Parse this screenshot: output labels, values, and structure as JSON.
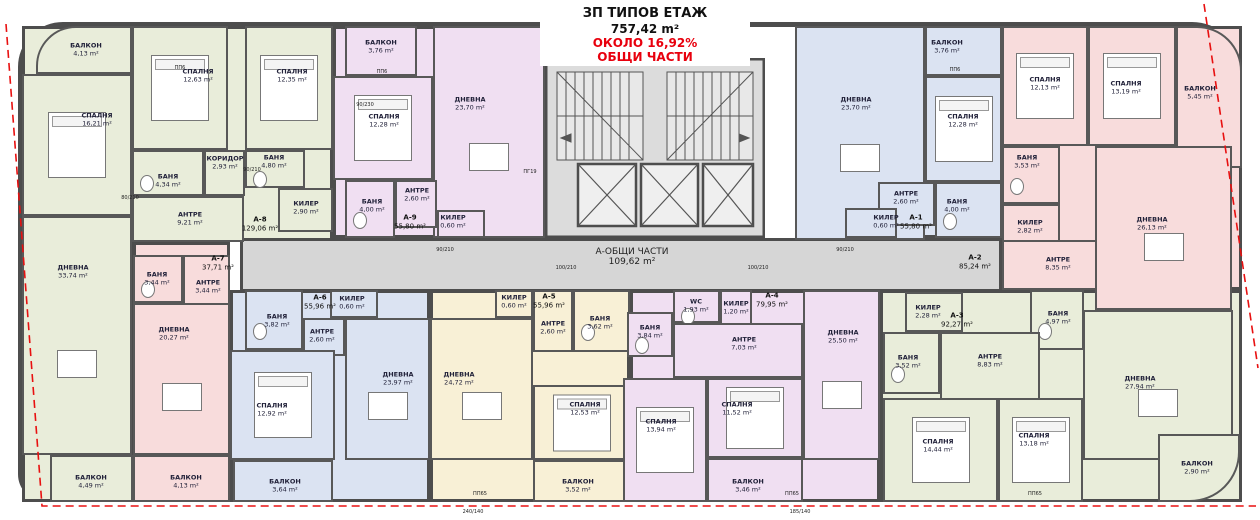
{
  "title": {
    "line1": "ЗП ТИПОВ ЕТАЖ",
    "line2": "757,42 m²",
    "line3": "ОКОЛО 16,92%",
    "line4": "ОБЩИ ЧАСТИ"
  },
  "common": {
    "label": "А-ОБЩИ ЧАСТИ",
    "area": "109,62 m²"
  },
  "colors": {
    "wall": "#4d4d4d",
    "green": "#e9edda",
    "pink": "#f8dcdc",
    "purple": "#f0dff2",
    "blue": "#dbe3f2",
    "yellow": "#f8f0d6",
    "gray": "#d6d6d6",
    "red": "#e8000d"
  },
  "apartments": [
    {
      "id": "А-1",
      "area": "55,80 m²",
      "x": 916,
      "y": 222
    },
    {
      "id": "А-2",
      "area": "85,24 m²",
      "x": 975,
      "y": 262
    },
    {
      "id": "А-3",
      "area": "92,27 m²",
      "x": 957,
      "y": 320
    },
    {
      "id": "А-4",
      "area": "79,95 m²",
      "x": 772,
      "y": 300
    },
    {
      "id": "А-5",
      "area": "55,96 m²",
      "x": 549,
      "y": 301
    },
    {
      "id": "А-6",
      "area": "55,96 m²",
      "x": 320,
      "y": 302
    },
    {
      "id": "А-7",
      "area": "37,71 m²",
      "x": 218,
      "y": 263
    },
    {
      "id": "А-8",
      "area": "129,06 m²",
      "x": 260,
      "y": 224
    },
    {
      "id": "А-9",
      "area": "55,80 m²",
      "x": 410,
      "y": 222
    }
  ],
  "apartment_zones": [
    {
      "id": "А-8",
      "r": [
        22,
        26,
        311,
        216
      ],
      "c": "green"
    },
    {
      "id": "А-8",
      "r": [
        22,
        216,
        111,
        286
      ],
      "c": "green"
    },
    {
      "id": "А-9",
      "r": [
        333,
        26,
        212,
        212
      ],
      "c": "purple"
    },
    {
      "id": "А-1",
      "r": [
        795,
        26,
        207,
        212
      ],
      "c": "blue"
    },
    {
      "id": "А-2",
      "r": [
        1000,
        26,
        242,
        264
      ],
      "c": "pink"
    },
    {
      "id": "А-3",
      "r": [
        880,
        290,
        362,
        212
      ],
      "c": "green"
    },
    {
      "id": "А-4",
      "r": [
        630,
        290,
        250,
        212
      ],
      "c": "purple"
    },
    {
      "id": "А-5",
      "r": [
        430,
        290,
        200,
        212
      ],
      "c": "yellow"
    },
    {
      "id": "А-6",
      "r": [
        230,
        290,
        200,
        212
      ],
      "c": "blue"
    },
    {
      "id": "А-7",
      "r": [
        133,
        242,
        97,
        260
      ],
      "c": "pink"
    },
    {
      "id": "corridor",
      "r": [
        240,
        238,
        762,
        54
      ],
      "c": "gray"
    },
    {
      "id": "core",
      "r": [
        545,
        58,
        220,
        180
      ],
      "c": "gray"
    }
  ],
  "rooms": [
    {
      "a": "А-8",
      "n": "БАЛКОН",
      "ar": "4,13 m²",
      "r": [
        36,
        26,
        96,
        48
      ],
      "c": "green",
      "rad": "40px 0 0 0",
      "lp": [
        86,
        50
      ]
    },
    {
      "a": "А-8",
      "n": "СПАЛНЯ",
      "ar": "12,63 m²",
      "r": [
        132,
        26,
        96,
        124
      ],
      "c": "green",
      "lp": [
        198,
        76
      ]
    },
    {
      "a": "А-8",
      "n": "СПАЛНЯ",
      "ar": "16,21 m²",
      "r": [
        22,
        74,
        110,
        142
      ],
      "c": "green",
      "lp": [
        97,
        120
      ]
    },
    {
      "a": "А-8",
      "n": "СПАЛНЯ",
      "ar": "12,35 m²",
      "r": [
        245,
        26,
        88,
        124
      ],
      "c": "green",
      "lp": [
        292,
        76
      ]
    },
    {
      "a": "А-8",
      "n": "КОРИДОР",
      "ar": "2,93 m²",
      "r": [
        204,
        150,
        41,
        46
      ],
      "c": "green",
      "lp": [
        225,
        163
      ]
    },
    {
      "a": "А-8",
      "n": "БАНЯ",
      "ar": "4,34 m²",
      "r": [
        132,
        150,
        72,
        46
      ],
      "c": "green",
      "lp": [
        168,
        181
      ]
    },
    {
      "a": "А-8",
      "n": "БАНЯ",
      "ar": "4,80 m²",
      "r": [
        245,
        150,
        60,
        38
      ],
      "c": "green",
      "lp": [
        274,
        162
      ]
    },
    {
      "a": "А-8",
      "n": "КИЛЕР",
      "ar": "2,90 m²",
      "r": [
        278,
        188,
        55,
        44
      ],
      "c": "green",
      "lp": [
        306,
        208
      ]
    },
    {
      "a": "А-8",
      "n": "АНТРЕ",
      "ar": "9,21 m²",
      "r": [
        132,
        196,
        112,
        46
      ],
      "c": "green",
      "lp": [
        190,
        219
      ]
    },
    {
      "a": "А-8",
      "n": "ДНЕВНА",
      "ar": "33,74 m²",
      "r": [
        22,
        216,
        110,
        239
      ],
      "c": "green",
      "lp": [
        73,
        272
      ]
    },
    {
      "a": "А-8",
      "n": "БАЛКОН",
      "ar": "4,49 m²",
      "r": [
        50,
        455,
        83,
        47
      ],
      "c": "green",
      "lp": [
        91,
        482
      ]
    },
    {
      "a": "А-7",
      "n": "БАНЯ",
      "ar": "3,44 m²",
      "r": [
        133,
        255,
        50,
        48
      ],
      "c": "pink",
      "lp": [
        157,
        279
      ]
    },
    {
      "a": "А-7",
      "n": "АНТРЕ",
      "ar": "3,44 m²",
      "r": [
        183,
        255,
        47,
        55
      ],
      "c": "pink",
      "lp": [
        208,
        287
      ]
    },
    {
      "a": "А-7",
      "n": "ДНЕВНА",
      "ar": "20,27 m²",
      "r": [
        133,
        303,
        97,
        152
      ],
      "c": "pink",
      "lp": [
        174,
        334
      ]
    },
    {
      "a": "А-7",
      "n": "БАЛКОН",
      "ar": "4,13 m²",
      "r": [
        133,
        455,
        97,
        47
      ],
      "c": "pink",
      "lp": [
        186,
        482
      ]
    },
    {
      "a": "А-6",
      "n": "БАНЯ",
      "ar": "3,82 m²",
      "r": [
        245,
        290,
        58,
        60
      ],
      "c": "blue",
      "lp": [
        277,
        321
      ]
    },
    {
      "a": "А-6",
      "n": "КИЛЕР",
      "ar": "0,60 m²",
      "r": [
        330,
        290,
        48,
        28
      ],
      "c": "blue",
      "lp": [
        352,
        303
      ]
    },
    {
      "a": "А-6",
      "n": "АНТРЕ",
      "ar": "2,60 m²",
      "r": [
        303,
        318,
        42,
        38
      ],
      "c": "blue",
      "lp": [
        322,
        336
      ]
    },
    {
      "a": "А-6",
      "n": "ДНЕВНА",
      "ar": "23,97 m²",
      "r": [
        345,
        318,
        85,
        142
      ],
      "c": "blue",
      "lp": [
        398,
        379
      ]
    },
    {
      "a": "А-6",
      "n": "СПАЛНЯ",
      "ar": "12,92 m²",
      "r": [
        230,
        350,
        105,
        110
      ],
      "c": "blue",
      "lp": [
        272,
        410
      ]
    },
    {
      "a": "А-6",
      "n": "БАЛКОН",
      "ar": "3,64 m²",
      "r": [
        233,
        460,
        100,
        42
      ],
      "c": "blue",
      "lp": [
        285,
        486
      ]
    },
    {
      "a": "А-5",
      "n": "КИЛЕР",
      "ar": "0,60 m²",
      "r": [
        495,
        290,
        38,
        28
      ],
      "c": "yellow",
      "lp": [
        514,
        302
      ]
    },
    {
      "a": "А-5",
      "n": "АНТРЕ",
      "ar": "2,60 m²",
      "r": [
        533,
        290,
        40,
        62
      ],
      "c": "yellow",
      "lp": [
        553,
        328
      ]
    },
    {
      "a": "А-5",
      "n": "БАНЯ",
      "ar": "3,62 m²",
      "r": [
        573,
        290,
        57,
        62
      ],
      "c": "yellow",
      "lp": [
        600,
        323
      ]
    },
    {
      "a": "А-5",
      "n": "ДНЕВНА",
      "ar": "24,72 m²",
      "r": [
        430,
        318,
        103,
        142
      ],
      "c": "yellow",
      "lp": [
        459,
        379
      ]
    },
    {
      "a": "А-5",
      "n": "СПАЛНЯ",
      "ar": "12,53 m²",
      "r": [
        533,
        385,
        97,
        75
      ],
      "c": "yellow",
      "lp": [
        585,
        409
      ]
    },
    {
      "a": "А-5",
      "n": "БАЛКОН",
      "ar": "3,52 m²",
      "r": [
        533,
        460,
        97,
        42
      ],
      "c": "yellow",
      "lp": [
        578,
        486
      ]
    },
    {
      "a": "А-4",
      "n": "БАНЯ",
      "ar": "3,84 m²",
      "r": [
        627,
        312,
        46,
        45
      ],
      "c": "purple",
      "lp": [
        650,
        332
      ]
    },
    {
      "a": "А-4",
      "n": "WC",
      "ar": "1,93 m²",
      "r": [
        673,
        290,
        47,
        33
      ],
      "c": "purple",
      "lp": [
        696,
        306
      ]
    },
    {
      "a": "А-4",
      "n": "КИЛЕР",
      "ar": "1,20 m²",
      "r": [
        720,
        290,
        32,
        37
      ],
      "c": "purple",
      "lp": [
        736,
        308
      ]
    },
    {
      "a": "А-4",
      "n": "АНТРЕ",
      "ar": "7,03 m²",
      "r": [
        673,
        323,
        130,
        55
      ],
      "c": "purple",
      "lp": [
        744,
        344
      ]
    },
    {
      "a": "А-4",
      "n": "ДНЕВНА",
      "ar": "25,50 m²",
      "r": [
        803,
        290,
        77,
        170
      ],
      "c": "purple",
      "lp": [
        843,
        337
      ]
    },
    {
      "a": "А-4",
      "n": "СПАЛНЯ",
      "ar": "13,94 m²",
      "r": [
        623,
        378,
        84,
        124
      ],
      "c": "purple",
      "lp": [
        661,
        426
      ]
    },
    {
      "a": "А-4",
      "n": "СПАЛНЯ",
      "ar": "11,52 m²",
      "r": [
        707,
        378,
        96,
        80
      ],
      "c": "purple",
      "lp": [
        737,
        409
      ]
    },
    {
      "a": "А-4",
      "n": "БАЛКОН",
      "ar": "3,46 m²",
      "r": [
        707,
        458,
        96,
        44
      ],
      "c": "purple",
      "lp": [
        748,
        486
      ]
    },
    {
      "a": "А-3",
      "n": "КИЛЕР",
      "ar": "2,28 m²",
      "r": [
        905,
        292,
        58,
        40
      ],
      "c": "green",
      "lp": [
        928,
        312
      ]
    },
    {
      "a": "А-3",
      "n": "БАНЯ",
      "ar": "4,97 m²",
      "r": [
        1030,
        290,
        54,
        60
      ],
      "c": "green",
      "lp": [
        1058,
        318
      ]
    },
    {
      "a": "А-3",
      "n": "БАНЯ",
      "ar": "3,52 m²",
      "r": [
        883,
        332,
        57,
        62
      ],
      "c": "green",
      "lp": [
        908,
        362
      ]
    },
    {
      "a": "А-3",
      "n": "АНТРЕ",
      "ar": "8,83 m²",
      "r": [
        940,
        332,
        100,
        70
      ],
      "c": "green",
      "lp": [
        990,
        361
      ]
    },
    {
      "a": "А-3",
      "n": "ДНЕВНА",
      "ar": "27,94 m²",
      "r": [
        1083,
        310,
        150,
        150
      ],
      "c": "green",
      "lp": [
        1140,
        383
      ]
    },
    {
      "a": "А-3",
      "n": "СПАЛНЯ",
      "ar": "14,44 m²",
      "r": [
        883,
        398,
        115,
        104
      ],
      "c": "green",
      "lp": [
        938,
        446
      ]
    },
    {
      "a": "А-3",
      "n": "СПАЛНЯ",
      "ar": "13,18 m²",
      "r": [
        998,
        398,
        85,
        104
      ],
      "c": "green",
      "lp": [
        1034,
        440
      ]
    },
    {
      "a": "А-3",
      "n": "БАЛКОН",
      "ar": "2,90 m²",
      "r": [
        1158,
        434,
        82,
        68
      ],
      "c": "green",
      "rad": "0 0 50px 0",
      "lp": [
        1197,
        468
      ]
    },
    {
      "a": "А-2",
      "n": "СПАЛНЯ",
      "ar": "12,13 m²",
      "r": [
        1002,
        26,
        86,
        120
      ],
      "c": "pink",
      "lp": [
        1045,
        84
      ]
    },
    {
      "a": "А-2",
      "n": "СПАЛНЯ",
      "ar": "13,19 m²",
      "r": [
        1088,
        26,
        88,
        120
      ],
      "c": "pink",
      "lp": [
        1126,
        88
      ]
    },
    {
      "a": "А-2",
      "n": "БАЛКОН",
      "ar": "5,45 m²",
      "r": [
        1176,
        26,
        66,
        142
      ],
      "c": "pink",
      "rad": "0 45px 0 0",
      "lp": [
        1200,
        93
      ]
    },
    {
      "a": "А-2",
      "n": "БАНЯ",
      "ar": "3,53 m²",
      "r": [
        1002,
        146,
        58,
        58
      ],
      "c": "pink",
      "lp": [
        1027,
        162
      ]
    },
    {
      "a": "А-2",
      "n": "КИЛЕР",
      "ar": "2,82 m²",
      "r": [
        1002,
        204,
        58,
        52
      ],
      "c": "pink",
      "lp": [
        1030,
        227
      ]
    },
    {
      "a": "А-2",
      "n": "АНТРЕ",
      "ar": "8,35 m²",
      "r": [
        1002,
        240,
        98,
        50
      ],
      "c": "pink",
      "lp": [
        1058,
        264
      ]
    },
    {
      "a": "А-2",
      "n": "ДНЕВНА",
      "ar": "26,13 m²",
      "r": [
        1095,
        146,
        137,
        164
      ],
      "c": "pink",
      "lp": [
        1152,
        224
      ]
    },
    {
      "a": "А-9",
      "n": "БАЛКОН",
      "ar": "3,76 m²",
      "r": [
        345,
        26,
        72,
        50
      ],
      "c": "purple",
      "lp": [
        381,
        47
      ]
    },
    {
      "a": "А-9",
      "n": "СПАЛНЯ",
      "ar": "12,28 m²",
      "r": [
        333,
        76,
        100,
        104
      ],
      "c": "purple",
      "lp": [
        384,
        121
      ]
    },
    {
      "a": "А-9",
      "n": "ДНЕВНА",
      "ar": "23,70 m²",
      "r": [
        433,
        26,
        112,
        212
      ],
      "c": "purple",
      "lp": [
        470,
        104
      ]
    },
    {
      "a": "А-9",
      "n": "БАНЯ",
      "ar": "4,00 m²",
      "r": [
        345,
        180,
        50,
        58
      ],
      "c": "purple",
      "lp": [
        372,
        206
      ]
    },
    {
      "a": "А-9",
      "n": "АНТРЕ",
      "ar": "2,60 m²",
      "r": [
        395,
        180,
        42,
        48
      ],
      "c": "purple",
      "lp": [
        417,
        195
      ]
    },
    {
      "a": "А-9",
      "n": "КИЛЕР",
      "ar": "0,60 m²",
      "r": [
        437,
        210,
        48,
        28
      ],
      "c": "purple",
      "lp": [
        453,
        222
      ]
    },
    {
      "a": "А-1",
      "n": "ДНЕВНА",
      "ar": "23,70 m²",
      "r": [
        795,
        26,
        130,
        214
      ],
      "c": "blue",
      "lp": [
        856,
        104
      ]
    },
    {
      "a": "А-1",
      "n": "БАЛКОН",
      "ar": "3,76 m²",
      "r": [
        925,
        26,
        77,
        50
      ],
      "c": "blue",
      "lp": [
        947,
        47
      ]
    },
    {
      "a": "А-1",
      "n": "СПАЛНЯ",
      "ar": "12,28 m²",
      "r": [
        925,
        76,
        77,
        106
      ],
      "c": "blue",
      "lp": [
        963,
        121
      ]
    },
    {
      "a": "А-1",
      "n": "АНТРЕ",
      "ar": "2,60 m²",
      "r": [
        878,
        182,
        57,
        44
      ],
      "c": "blue",
      "lp": [
        906,
        198
      ]
    },
    {
      "a": "А-1",
      "n": "БАНЯ",
      "ar": "4,00 m²",
      "r": [
        935,
        182,
        67,
        56
      ],
      "c": "blue",
      "lp": [
        957,
        206
      ]
    },
    {
      "a": "А-1",
      "n": "КИЛЕР",
      "ar": "0,60 m²",
      "r": [
        845,
        208,
        52,
        30
      ],
      "c": "blue",
      "lp": [
        886,
        222
      ]
    }
  ],
  "dimension_marks": [
    {
      "t": "90/210",
      "x": 252,
      "y": 170
    },
    {
      "t": "80/210",
      "x": 130,
      "y": 198
    },
    {
      "t": "100/210",
      "x": 566,
      "y": 268
    },
    {
      "t": "100/210",
      "x": 758,
      "y": 268
    },
    {
      "t": "90/210",
      "x": 445,
      "y": 250
    },
    {
      "t": "90/210",
      "x": 845,
      "y": 250
    },
    {
      "t": "90/230",
      "x": 365,
      "y": 105
    },
    {
      "t": "ПП65",
      "x": 480,
      "y": 494
    },
    {
      "t": "ПП65",
      "x": 792,
      "y": 494
    },
    {
      "t": "ПП65",
      "x": 1035,
      "y": 494
    },
    {
      "t": "ПП6",
      "x": 180,
      "y": 68
    },
    {
      "t": "ПП6",
      "x": 382,
      "y": 72
    },
    {
      "t": "ПП6",
      "x": 955,
      "y": 70
    },
    {
      "t": "ПГ19",
      "x": 530,
      "y": 172
    },
    {
      "t": "240/140",
      "x": 473,
      "y": 512
    },
    {
      "t": "185/140",
      "x": 800,
      "y": 512
    }
  ]
}
